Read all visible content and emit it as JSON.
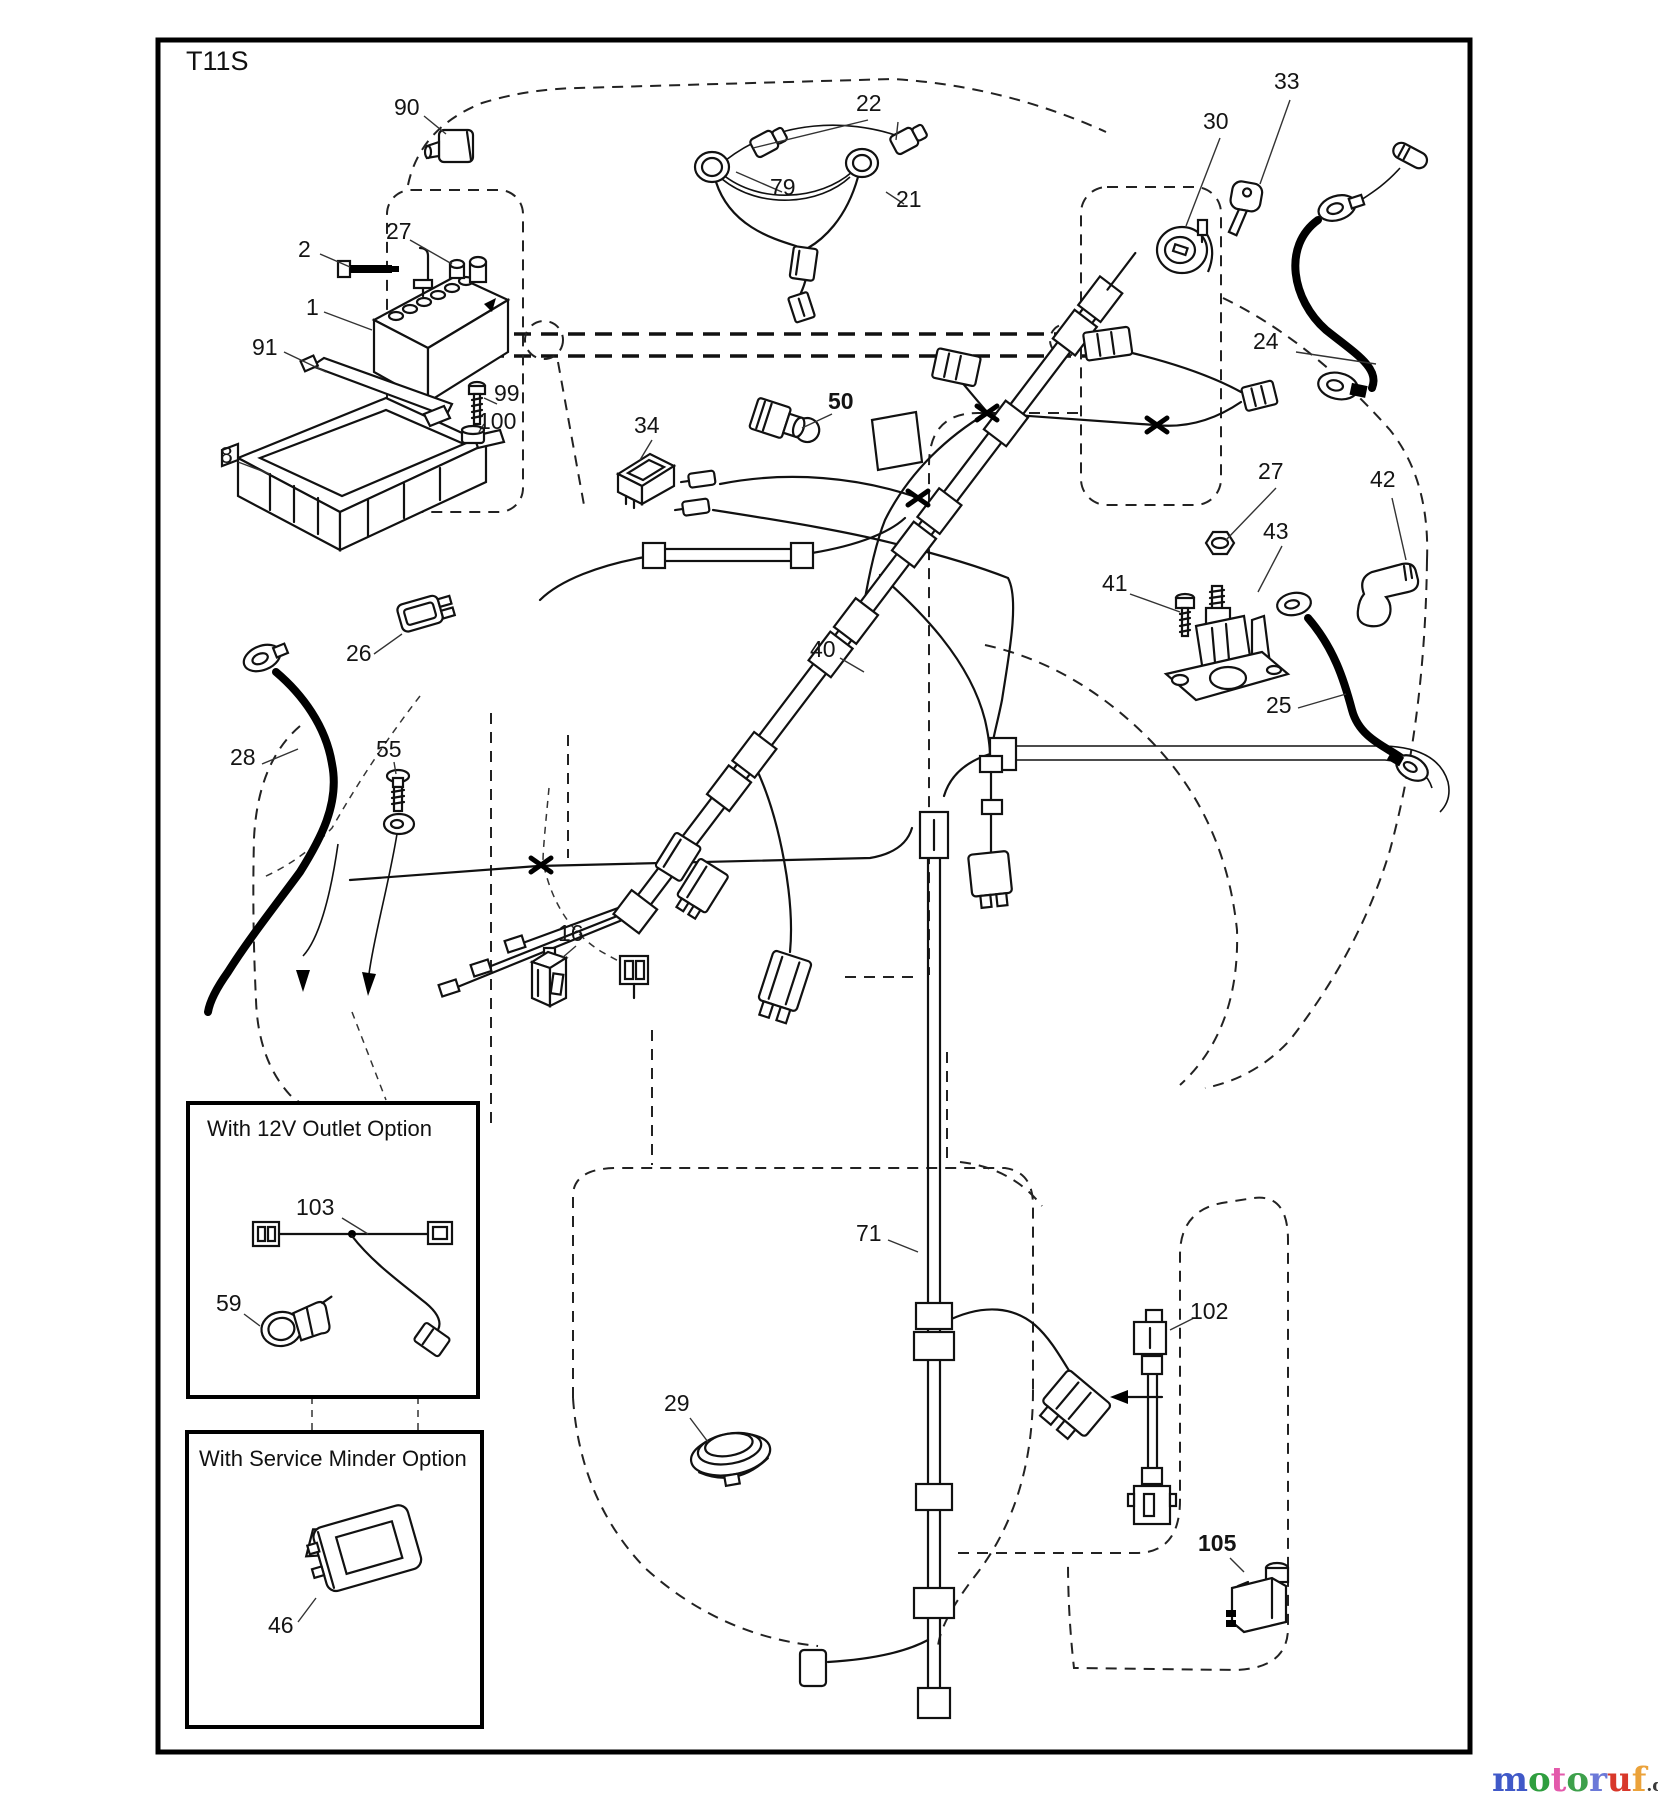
{
  "header": {
    "sheet_code": "T11S"
  },
  "boxes": {
    "outlet": {
      "title": "With 12V Outlet Option"
    },
    "service": {
      "title": "With Service Minder Option"
    }
  },
  "callouts": [
    {
      "id": "90",
      "text": "90",
      "x": 394,
      "y": 96
    },
    {
      "id": "22",
      "text": "22",
      "x": 856,
      "y": 92
    },
    {
      "id": "79",
      "text": "79",
      "x": 770,
      "y": 176
    },
    {
      "id": "21",
      "text": "21",
      "x": 896,
      "y": 188
    },
    {
      "id": "30",
      "text": "30",
      "x": 1203,
      "y": 110
    },
    {
      "id": "33",
      "text": "33",
      "x": 1274,
      "y": 70
    },
    {
      "id": "24",
      "text": "24",
      "x": 1253,
      "y": 330
    },
    {
      "id": "2",
      "text": "2",
      "x": 298,
      "y": 238
    },
    {
      "id": "27a",
      "text": "27",
      "x": 386,
      "y": 220
    },
    {
      "id": "1",
      "text": "1",
      "x": 306,
      "y": 296
    },
    {
      "id": "91",
      "text": "91",
      "x": 252,
      "y": 336
    },
    {
      "id": "99",
      "text": "99",
      "x": 494,
      "y": 382
    },
    {
      "id": "100",
      "text": "100",
      "x": 478,
      "y": 410
    },
    {
      "id": "8",
      "text": "8",
      "x": 220,
      "y": 444
    },
    {
      "id": "34",
      "text": "34",
      "x": 634,
      "y": 414
    },
    {
      "id": "50",
      "text": "50",
      "x": 828,
      "y": 390,
      "bold": true
    },
    {
      "id": "26",
      "text": "26",
      "x": 346,
      "y": 642
    },
    {
      "id": "40",
      "text": "40",
      "x": 810,
      "y": 638
    },
    {
      "id": "28",
      "text": "28",
      "x": 230,
      "y": 746
    },
    {
      "id": "55",
      "text": "55",
      "x": 376,
      "y": 738
    },
    {
      "id": "41",
      "text": "41",
      "x": 1102,
      "y": 572
    },
    {
      "id": "27b",
      "text": "27",
      "x": 1258,
      "y": 460
    },
    {
      "id": "43",
      "text": "43",
      "x": 1263,
      "y": 520
    },
    {
      "id": "42",
      "text": "42",
      "x": 1370,
      "y": 468
    },
    {
      "id": "25",
      "text": "25",
      "x": 1266,
      "y": 694
    },
    {
      "id": "16",
      "text": "16",
      "x": 558,
      "y": 922
    },
    {
      "id": "29",
      "text": "29",
      "x": 664,
      "y": 1392
    },
    {
      "id": "71",
      "text": "71",
      "x": 856,
      "y": 1222
    },
    {
      "id": "102",
      "text": "102",
      "x": 1190,
      "y": 1300
    },
    {
      "id": "103",
      "text": "103",
      "x": 296,
      "y": 1196
    },
    {
      "id": "59",
      "text": "59",
      "x": 216,
      "y": 1292
    },
    {
      "id": "46",
      "text": "46",
      "x": 268,
      "y": 1614
    },
    {
      "id": "105",
      "text": "105",
      "x": 1198,
      "y": 1532,
      "bold": true
    }
  ],
  "watermark": {
    "letters": [
      {
        "ch": "m",
        "color": "#4059c8"
      },
      {
        "ch": "o",
        "color": "#2f9e3f"
      },
      {
        "ch": "t",
        "color": "#e35aab"
      },
      {
        "ch": "o",
        "color": "#3da04b"
      },
      {
        "ch": "r",
        "color": "#6b79d8"
      },
      {
        "ch": "u",
        "color": "#d8382a"
      },
      {
        "ch": "f",
        "color": "#eba23a"
      }
    ],
    "suffix": ".de",
    "suffix_color": "#3a3a3a"
  }
}
